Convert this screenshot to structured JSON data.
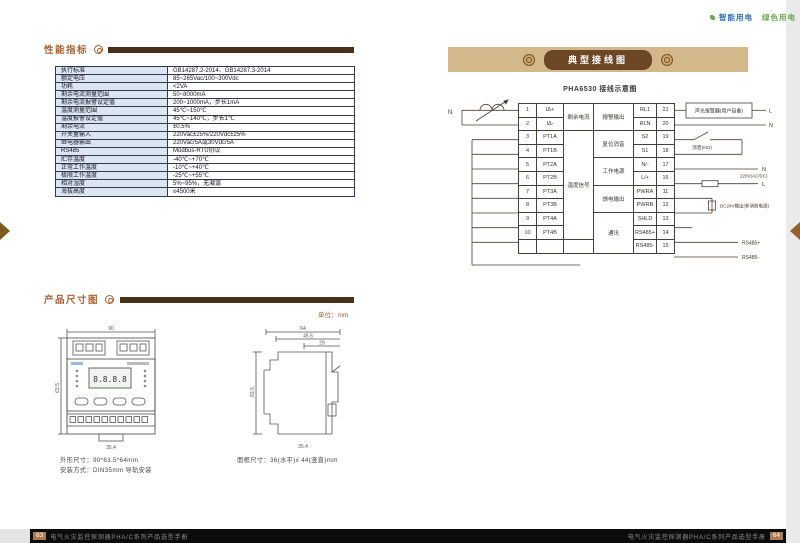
{
  "tagline": {
    "item1": "智能用电",
    "item2": "绿色用电"
  },
  "colors": {
    "accent_brown": "#a5612f",
    "bar_brown": "#46301a",
    "banner_tan": "#d3b88c",
    "pill_brown": "#6b4726",
    "table_header_bg": "#dce6f1",
    "table_border": "#2d3a50",
    "tagline_blue": "#2f6eb5",
    "tagline_green": "#6aa84f",
    "footer_black": "#0c0c0c",
    "page_number_brown": "#a87c50"
  },
  "left_page": {
    "sections": {
      "performance": "性能指标",
      "dimensions": "产品尺寸图"
    },
    "unit_label": "单位：mm",
    "spec_rows": [
      {
        "label": "执行标准",
        "value": "GB14287.2-2014、GB14287.3-2014"
      },
      {
        "label": "额定电压",
        "value": "85~265Vac/100~300Vdc"
      },
      {
        "label": "功耗",
        "value": "<2VA"
      },
      {
        "label": "剩余电流测量范围",
        "value": "50~8000mA"
      },
      {
        "label": "剩余电流报警设定值",
        "value": "200~1000mA，步长1mA"
      },
      {
        "label": "温度测量范围",
        "value": "45℃~150℃"
      },
      {
        "label": "温度报警设定值",
        "value": "45℃~140℃，步长1℃"
      },
      {
        "label": "剩余电流",
        "value": "±0.5%"
      },
      {
        "label": "开关量输入",
        "value": "220Vac±25%/220Vdc±25%"
      },
      {
        "label": "继电器输出",
        "value": "220Vac/5A或30Vdc/5A"
      },
      {
        "label": "RS485",
        "value": "Modbus-RTU协议"
      },
      {
        "label": "贮存温度",
        "value": "-40℃~+70℃"
      },
      {
        "label": "正常工作温度",
        "value": "-10℃~+40℃"
      },
      {
        "label": "极限工作温度",
        "value": "-25℃~+55℃"
      },
      {
        "label": "相对湿度",
        "value": "5%~95%，无凝露"
      },
      {
        "label": "海拔高度",
        "value": "≤4500米"
      }
    ],
    "front_view": {
      "dim_top": "90",
      "dim_left": "63.5",
      "dim_bottom": "35.4",
      "lcd_text": "8.8.8.8"
    },
    "side_view": {
      "dim_top": "64",
      "dim_mid": "45.5",
      "dim_inner": "29",
      "dim_left": "63.5",
      "dim_bottom": "35.4"
    },
    "captions": {
      "size": "外形尺寸：90*63.5*64mm",
      "mount": "安装方式：DIN35mm 导轨安装",
      "panel": "面框尺寸：36(水平)x 44(竖直)mm"
    }
  },
  "right_page": {
    "banner_title": "典型接线图",
    "diagram": {
      "title": "PHA6530 接线示意图",
      "left_n": "N",
      "rows": [
        {
          "no": "1",
          "name": "IΔ+"
        },
        {
          "no": "2",
          "name": "IΔ-"
        },
        {
          "no": "3",
          "name": "PT1A"
        },
        {
          "no": "4",
          "name": "PT1B"
        },
        {
          "no": "5",
          "name": "PT2A"
        },
        {
          "no": "6",
          "name": "PT2B"
        },
        {
          "no": "7",
          "name": "PT3A"
        },
        {
          "no": "8",
          "name": "PT3B"
        },
        {
          "no": "9",
          "name": "PT4A"
        },
        {
          "no": "10",
          "name": "PT4B"
        }
      ],
      "group_left1": "剩余电流",
      "group_left2": "温度信号",
      "group_right": [
        "报警输出",
        "复位消音",
        "工作电源",
        "馈电输出",
        "通讯"
      ],
      "right_rows": [
        {
          "name": "RL1",
          "no": "21"
        },
        {
          "name": "RLN",
          "no": "20"
        },
        {
          "name": "S2",
          "no": "19"
        },
        {
          "name": "S1",
          "no": "18"
        },
        {
          "name": "N/-",
          "no": "17"
        },
        {
          "name": "L/+",
          "no": "16"
        },
        {
          "name": "PWRA",
          "no": "11"
        },
        {
          "name": "PWRB",
          "no": "12"
        },
        {
          "name": "SHLD",
          "no": "13"
        },
        {
          "name": "RS485+",
          "no": "14"
        },
        {
          "name": "RS485-",
          "no": "15"
        }
      ],
      "ann": {
        "alarm_box": "声光报警器(用户自备)",
        "alarm_l": "L",
        "alarm_n": "N",
        "mute": "消音(NO)",
        "pwr_label": "220V(AC/DC)",
        "pwr_n": "N",
        "pwr_l": "L",
        "feed": "DC24V输出(非消防电源)",
        "rs_p": "RS485+",
        "rs_n": "RS485-"
      }
    }
  },
  "footer": {
    "left_no": "63",
    "left_text": "电气火灾监控探测器PHA/C系列产品选型手册",
    "right_text": "电气火灾监控探测器PHA/C系列产品选型手册",
    "right_no": "64"
  }
}
